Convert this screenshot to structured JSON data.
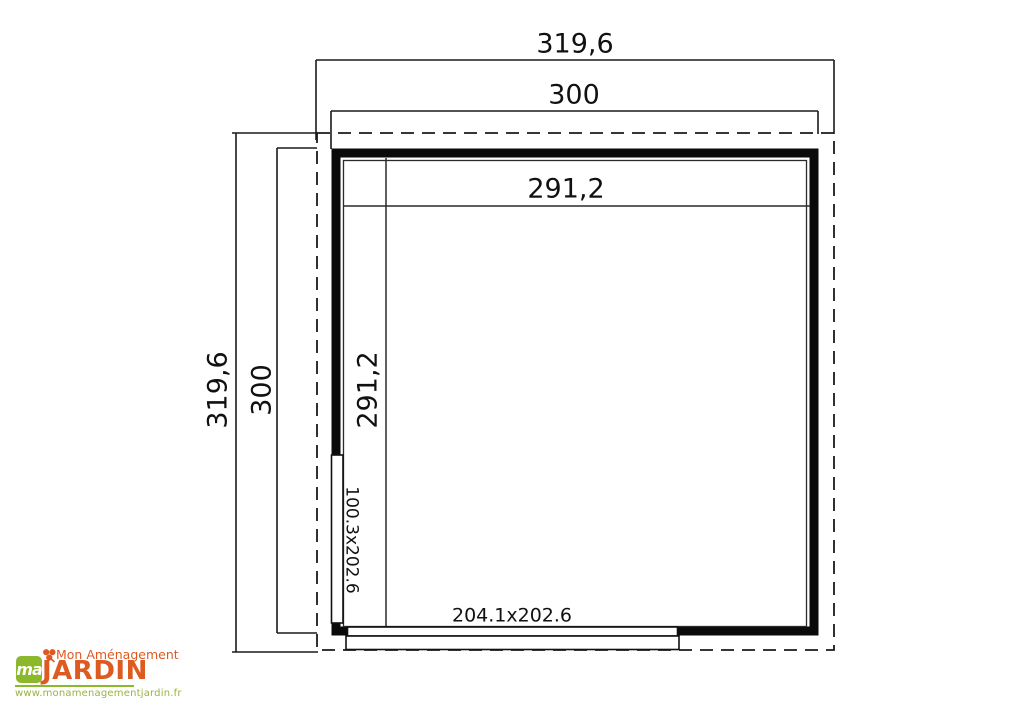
{
  "diagram": {
    "dimensions": {
      "outer_width": "319,6",
      "outer_height": "319,6",
      "wall_width": "300",
      "wall_height": "300",
      "inner_width": "291,2",
      "inner_height": "291,2"
    },
    "openings": {
      "side_door_size": "100.3x202.6",
      "front_door_size": "204.1x202.6"
    },
    "line_color": "#1a1a1a"
  },
  "logo": {
    "monogram": "ma",
    "tagline": "Mon Aménagement",
    "brand": "JARDIN",
    "website": "www.monamenagementjardin.fr",
    "orange": "#DD5A20",
    "green": "#8CB82B"
  }
}
